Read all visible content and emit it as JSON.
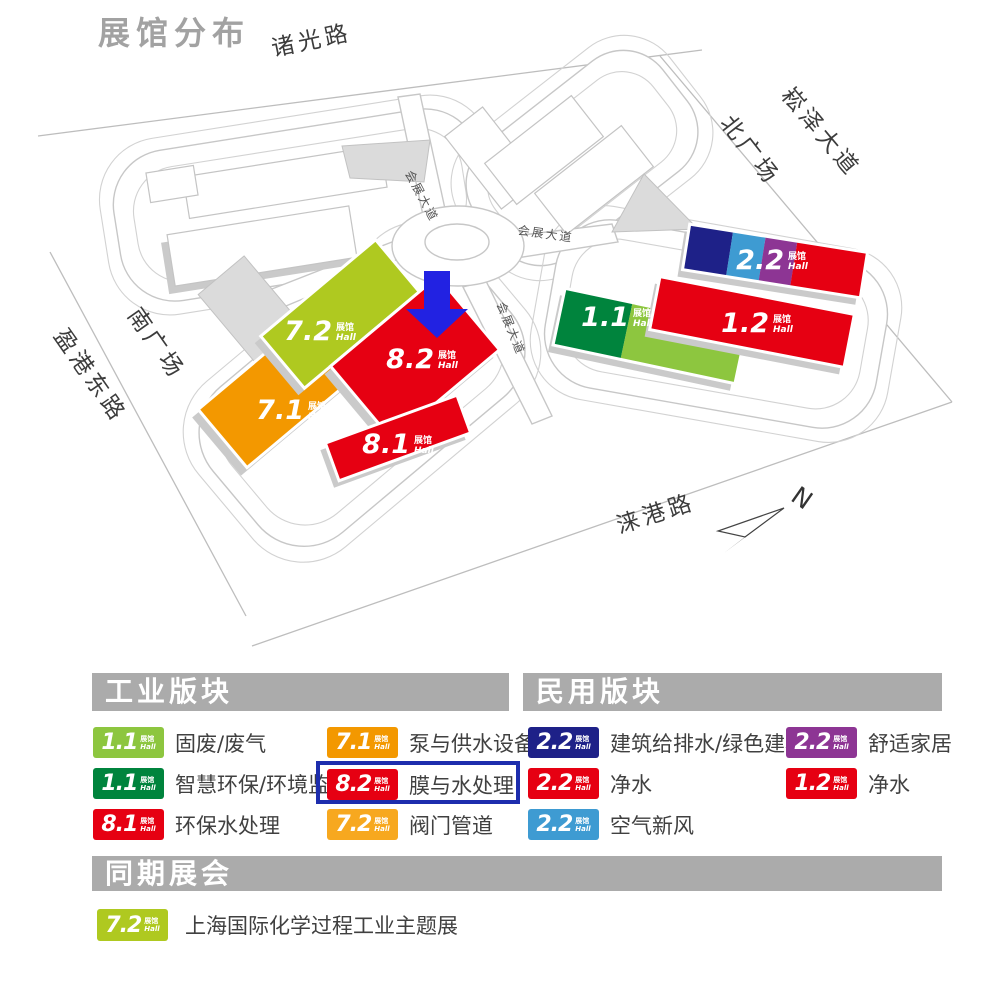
{
  "title": "展馆分布",
  "colors": {
    "red": "#E60012",
    "orange": "#F39800",
    "orange_light": "#F7A81F",
    "lime": "#AFC920",
    "light_green": "#8DC63F",
    "dark_green": "#00843D",
    "navy": "#1E2188",
    "light_blue": "#3E9BD2",
    "purple": "#8D3594",
    "arrow_blue": "#2222E2",
    "highlight_box_blue": "#1D2DAD",
    "header_gray": "#ABABAB"
  },
  "map": {
    "roads": {
      "zhuguang": "诸光路",
      "songze": "崧泽大道",
      "north_square": "北广场",
      "south_square": "南广场",
      "yinggang": "盈港东路",
      "laigang": "涞港路",
      "avenue": "会展大道"
    },
    "compass": "N",
    "hall_suffix": {
      "zh": "展馆",
      "en": "Hall"
    },
    "halls": {
      "h72": "7.2",
      "h71": "7.1",
      "h82": "8.2",
      "h81": "8.1",
      "h11": "1.1",
      "h12": "1.2",
      "h22": "2.2"
    }
  },
  "legend": {
    "badge_suffix": {
      "zh": "展馆",
      "en": "Hall"
    },
    "industrial": {
      "header": "工业版块",
      "items": [
        {
          "num": "1.1",
          "label": "固废/废气",
          "color": "#8DC63F",
          "highlight": false
        },
        {
          "num": "1.1",
          "label": "智慧环保/环境监测",
          "color": "#00843D",
          "highlight": false
        },
        {
          "num": "8.1",
          "label": "环保水处理",
          "color": "#E60012",
          "highlight": false
        },
        {
          "num": "7.1",
          "label": "泵与供水设备",
          "color": "#F39800",
          "highlight": false
        },
        {
          "num": "8.2",
          "label": "膜与水处理",
          "color": "#E60012",
          "highlight": true
        },
        {
          "num": "7.2",
          "label": "阀门管道",
          "color": "#F7A81F",
          "highlight": false
        }
      ]
    },
    "civil": {
      "header": "民用版块",
      "items": [
        {
          "num": "2.2",
          "label": "建筑给排水/绿色建材",
          "color": "#1E2188",
          "highlight": false
        },
        {
          "num": "2.2",
          "label": "净水",
          "color": "#E60012",
          "highlight": false
        },
        {
          "num": "2.2",
          "label": "空气新风",
          "color": "#3E9BD2",
          "highlight": false
        },
        {
          "num": "2.2",
          "label": "舒适家居",
          "color": "#8D3594",
          "highlight": false
        },
        {
          "num": "1.2",
          "label": "净水",
          "color": "#E60012",
          "highlight": false
        }
      ]
    },
    "concurrent": {
      "header": "同期展会",
      "items": [
        {
          "num": "7.2",
          "label": "上海国际化学过程工业主题展",
          "color": "#AFC920",
          "highlight": false
        }
      ]
    }
  }
}
